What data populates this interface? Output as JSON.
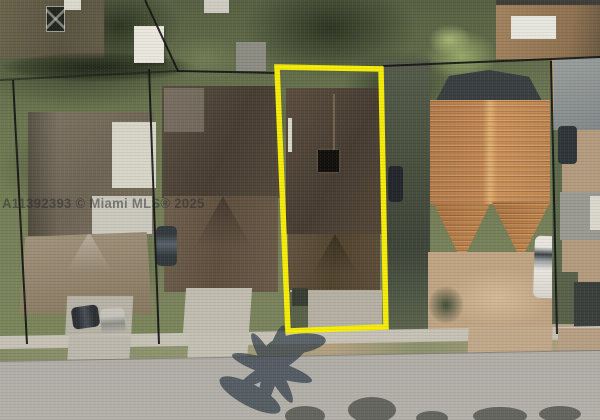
{
  "meta": {
    "width_px": 600,
    "height_px": 420,
    "type": "aerial-property-photo"
  },
  "photo": {
    "watermark": "A11392393 © Miami MLS® 2025",
    "scene": "Overhead aerial view of residential lots; subject lot outlined in yellow between neighboring houses, street at bottom"
  },
  "colors": {
    "highlight_outline": "#f6ec0a",
    "parcel_line": "#161616",
    "watermark_color": "#2b2b30",
    "road": "#aaa7a1",
    "grass": "#6f7a54",
    "tile_roof": "#c08550",
    "shingle_roof": "#50443a"
  }
}
